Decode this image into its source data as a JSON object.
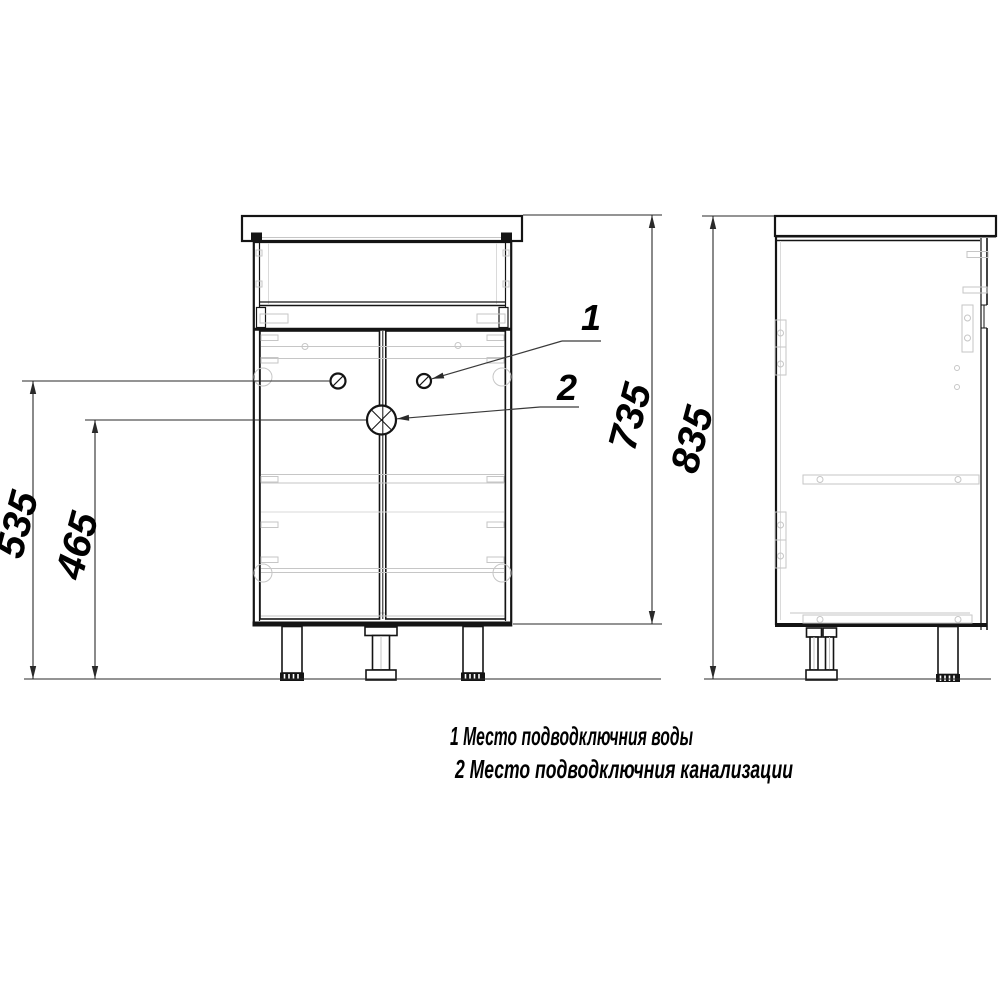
{
  "dimensions": {
    "d535": "535",
    "d465": "465",
    "d735": "735",
    "d835": "835"
  },
  "callouts": {
    "c1": "1",
    "c2": "2"
  },
  "legend": {
    "line1": "1 Место подводключния воды",
    "line2": "2 Место подводключния канализации"
  },
  "colors": {
    "line": "#141414",
    "detail": "#c6c6c6",
    "background": "#ffffff"
  }
}
